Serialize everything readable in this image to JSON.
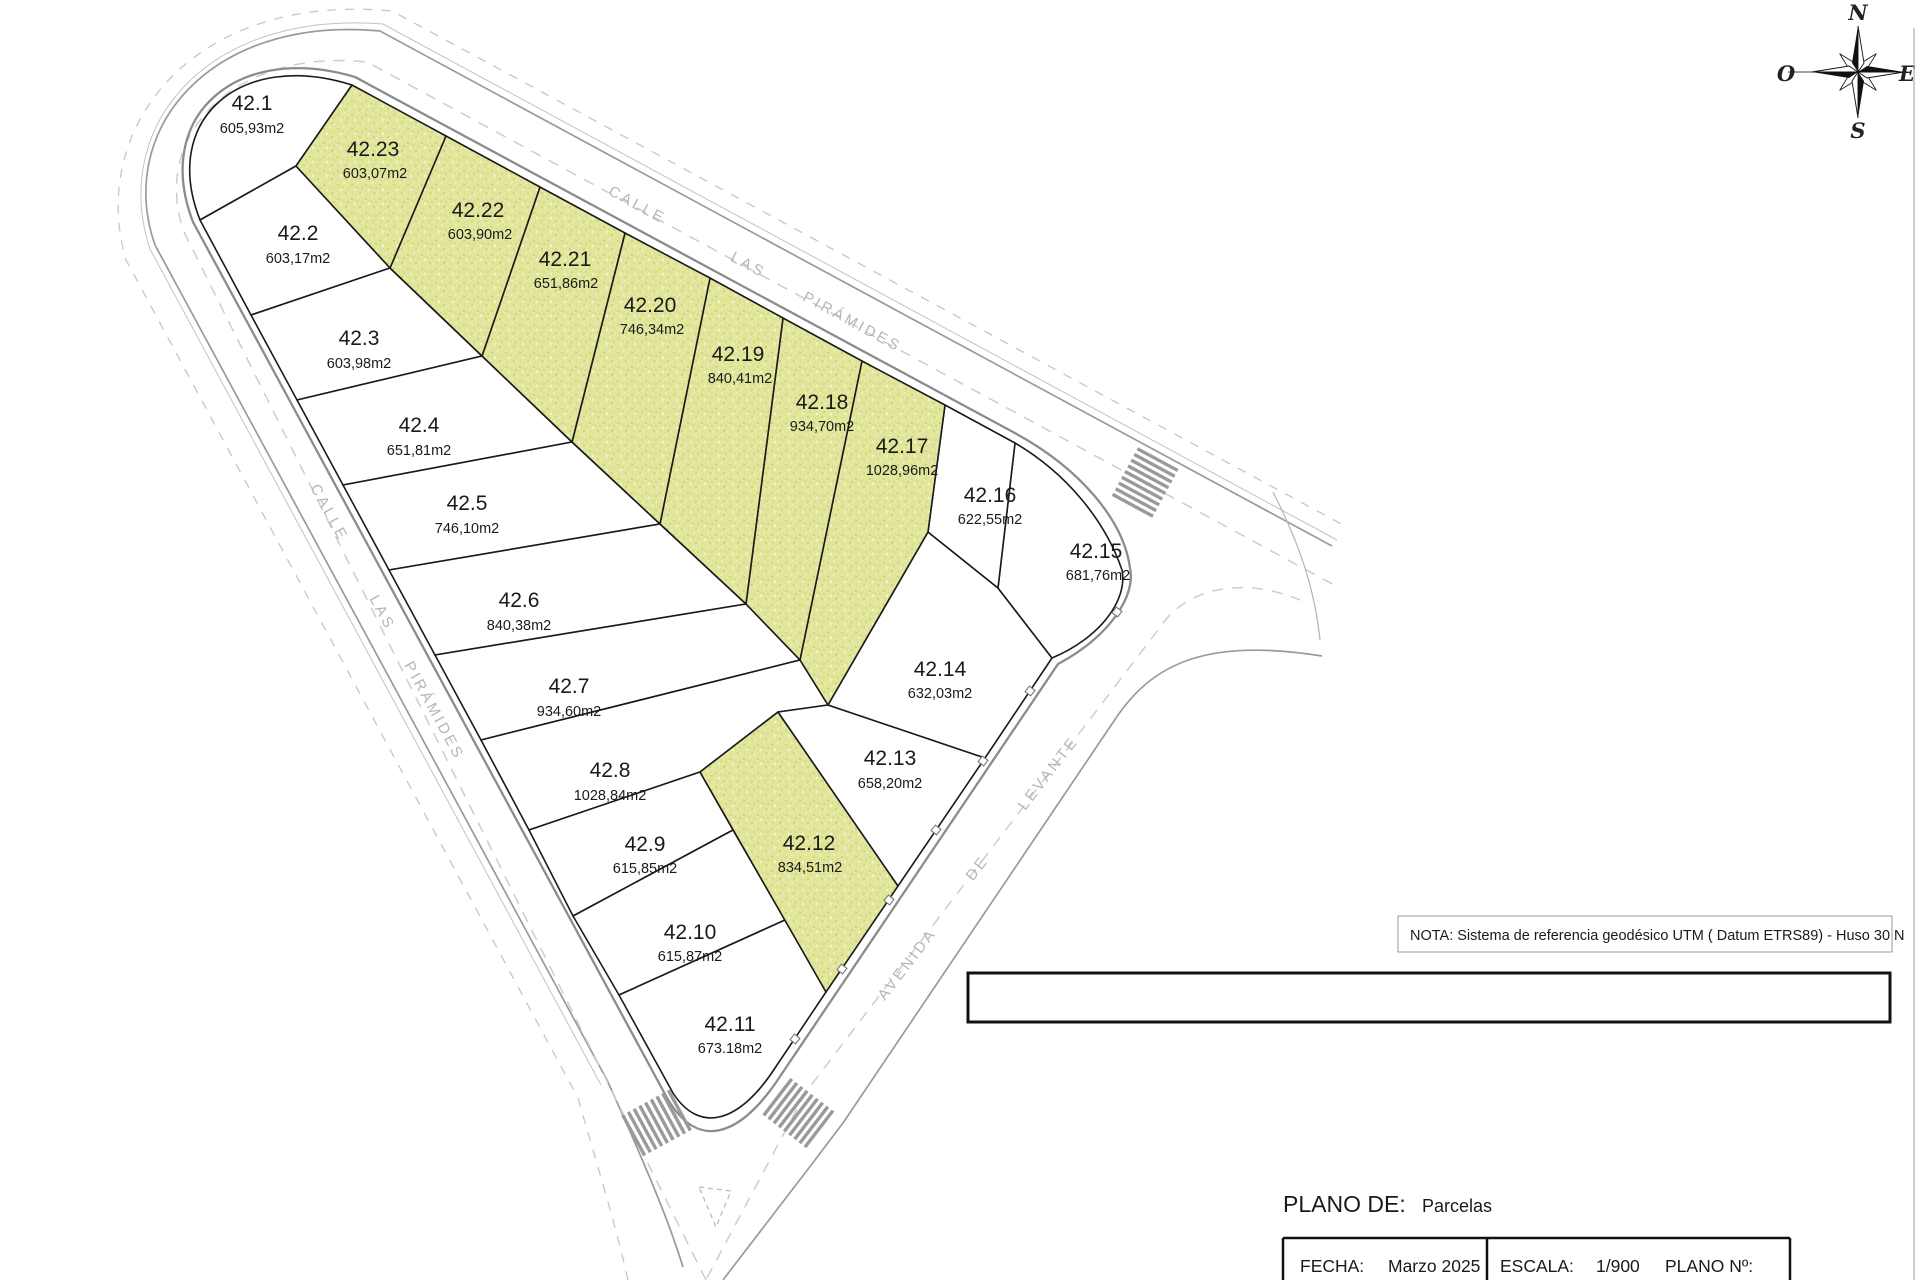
{
  "map": {
    "parcels": [
      {
        "id": "42.1",
        "area": "605,93m2",
        "highlighted": false
      },
      {
        "id": "42.2",
        "area": "603,17m2",
        "highlighted": false
      },
      {
        "id": "42.3",
        "area": "603,98m2",
        "highlighted": false
      },
      {
        "id": "42.4",
        "area": "651,81m2",
        "highlighted": false
      },
      {
        "id": "42.5",
        "area": "746,10m2",
        "highlighted": false
      },
      {
        "id": "42.6",
        "area": "840,38m2",
        "highlighted": false
      },
      {
        "id": "42.7",
        "area": "934,60m2",
        "highlighted": false
      },
      {
        "id": "42.8",
        "area": "1028,84m2",
        "highlighted": false
      },
      {
        "id": "42.9",
        "area": "615,85m2",
        "highlighted": false
      },
      {
        "id": "42.10",
        "area": "615,87m2",
        "highlighted": false
      },
      {
        "id": "42.11",
        "area": "673.18m2",
        "highlighted": false
      },
      {
        "id": "42.12",
        "area": "834,51m2",
        "highlighted": true
      },
      {
        "id": "42.13",
        "area": "658,20m2",
        "highlighted": false
      },
      {
        "id": "42.14",
        "area": "632,03m2",
        "highlighted": false
      },
      {
        "id": "42.15",
        "area": "681,76m2",
        "highlighted": false
      },
      {
        "id": "42.16",
        "area": "622,55m2",
        "highlighted": false
      },
      {
        "id": "42.17",
        "area": "1028,96m2",
        "highlighted": true
      },
      {
        "id": "42.18",
        "area": "934,70m2",
        "highlighted": true
      },
      {
        "id": "42.19",
        "area": "840,41m2",
        "highlighted": true
      },
      {
        "id": "42.20",
        "area": "746,34m2",
        "highlighted": true
      },
      {
        "id": "42.21",
        "area": "651,86m2",
        "highlighted": true
      },
      {
        "id": "42.22",
        "area": "603,90m2",
        "highlighted": true
      },
      {
        "id": "42.23",
        "area": "603,07m2",
        "highlighted": true
      }
    ],
    "streets": {
      "top": [
        "CALLE",
        "LAS",
        "PIRÁMIDES"
      ],
      "left": [
        "CALLE",
        "LAS",
        "PIRÁMIDES"
      ],
      "avenue": [
        "AVENIDA",
        "DE",
        "LEVANTE"
      ]
    }
  },
  "compass": {
    "n": "N",
    "e": "E",
    "s": "S",
    "w": "O"
  },
  "note": {
    "text": "NOTA:  Sistema de referencia geodésico UTM ( Datum ETRS89) - Huso 30 N"
  },
  "title_block": {
    "plano_de_label": "PLANO DE:",
    "plano_de_value": "Parcelas",
    "fecha_label": "FECHA:",
    "fecha_value": "Marzo 2025",
    "escala_label": "ESCALA:",
    "escala_value": "1/900",
    "plano_num_label": "PLANO Nº:"
  },
  "colors": {
    "highlight": "#dfe596",
    "road_edge": "#8c8c8c",
    "parcel_stroke": "#1a1a1a"
  }
}
